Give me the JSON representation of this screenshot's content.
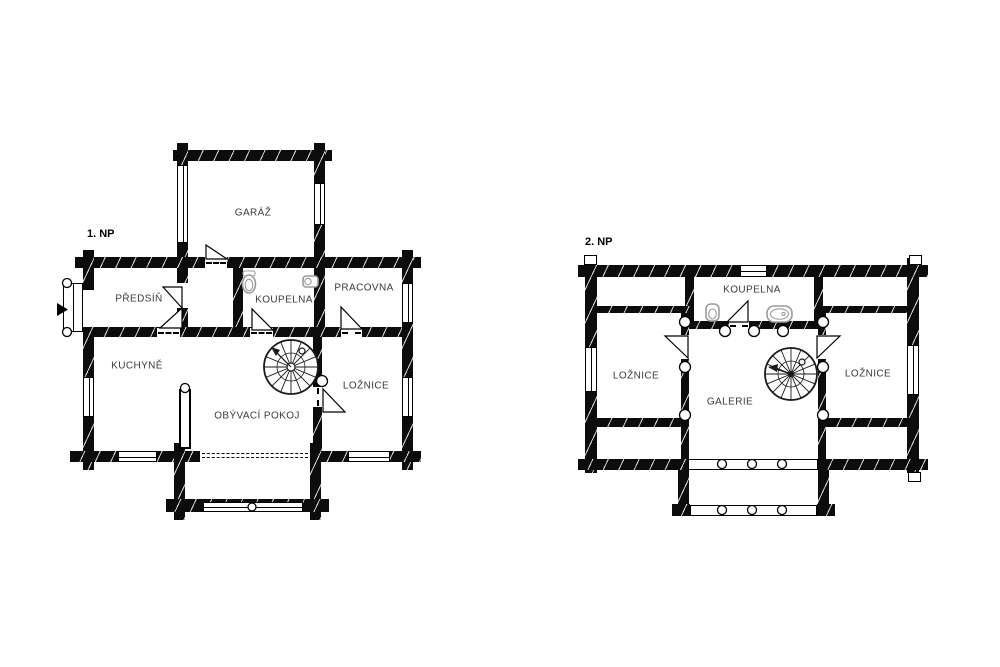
{
  "plans": {
    "first_floor": {
      "title": "1. NP",
      "rooms": {
        "garage": "GARÁŽ",
        "hall": "PŘEDSÍŇ",
        "bathroom": "KOUPELNA",
        "study": "PRACOVNA",
        "kitchen": "KUCHYNĚ",
        "living_room": "OBÝVACÍ POKOJ",
        "bedroom": "LOŽNICE"
      }
    },
    "second_floor": {
      "title": "2. NP",
      "rooms": {
        "bathroom": "KOUPELNA",
        "bedroom_left": "LOŽNICE",
        "gallery": "GALERIE",
        "bedroom_right": "LOŽNICE"
      }
    }
  },
  "colors": {
    "background": "#ffffff",
    "wall": "#0c0c0c",
    "wall_hatch": "#ffffff",
    "fixture_stroke": "#9b9b9b",
    "label_text": "#3a3a3a",
    "title_text": "#000000"
  },
  "icons": {
    "spiral_staircase": "spiral-staircase-icon",
    "toilet": "toilet-icon",
    "washbasin": "washbasin-icon",
    "bathtub": "bathtub-icon",
    "entrance_arrow": "entrance-arrow-icon",
    "log_post": "log-post-icon"
  }
}
